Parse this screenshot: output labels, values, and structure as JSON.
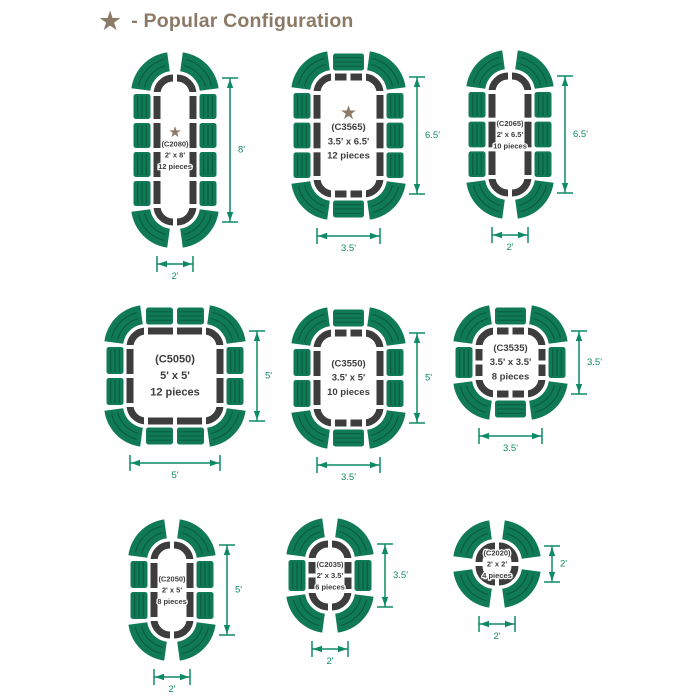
{
  "header": {
    "star_icon": "★",
    "title": "- Popular Configuration"
  },
  "colors": {
    "seat_green": "#107a57",
    "seat_stripe": "#0a5a40",
    "table_dark": "#3d3d3d",
    "dimension": "#0e8a66",
    "star": "#8c7a66",
    "background": "#ffffff"
  },
  "configurations": [
    {
      "id": "(C2080)",
      "size": "2' x 8'",
      "pieces": "12 pieces",
      "popular": true,
      "width_ft": 2,
      "height_ft": 8,
      "width_label": "2'",
      "height_label": "8'",
      "seats": {
        "left": 4,
        "right": 4,
        "top": 0,
        "bottom": 0,
        "corners": 4
      }
    },
    {
      "id": "(C3565)",
      "size": "3.5' x 6.5'",
      "pieces": "12 pieces",
      "popular": true,
      "width_ft": 3.5,
      "height_ft": 6.5,
      "width_label": "3.5'",
      "height_label": "6.5'",
      "seats": {
        "left": 3,
        "right": 3,
        "top": 1,
        "bottom": 1,
        "corners": 4
      }
    },
    {
      "id": "(C2065)",
      "size": "2' x 6.5'",
      "pieces": "10 pieces",
      "popular": false,
      "width_ft": 2,
      "height_ft": 6.5,
      "width_label": "2'",
      "height_label": "6.5'",
      "seats": {
        "left": 3,
        "right": 3,
        "top": 0,
        "bottom": 0,
        "corners": 4
      }
    },
    {
      "id": "(C5050)",
      "size": "5' x 5'",
      "pieces": "12 pieces",
      "popular": false,
      "width_ft": 5,
      "height_ft": 5,
      "width_label": "5'",
      "height_label": "5'",
      "seats": {
        "left": 2,
        "right": 2,
        "top": 2,
        "bottom": 2,
        "corners": 4
      }
    },
    {
      "id": "(C3550)",
      "size": "3.5' x 5'",
      "pieces": "10 pieces",
      "popular": false,
      "width_ft": 3.5,
      "height_ft": 5,
      "width_label": "3.5'",
      "height_label": "5'",
      "seats": {
        "left": 2,
        "right": 2,
        "top": 1,
        "bottom": 1,
        "corners": 4
      }
    },
    {
      "id": "(C3535)",
      "size": "3.5' x 3.5'",
      "pieces": "8 pieces",
      "popular": false,
      "width_ft": 3.5,
      "height_ft": 3.5,
      "width_label": "3.5'",
      "height_label": "3.5'",
      "seats": {
        "left": 1,
        "right": 1,
        "top": 1,
        "bottom": 1,
        "corners": 4
      }
    },
    {
      "id": "(C2050)",
      "size": "2' x 5'",
      "pieces": "8 pieces",
      "popular": false,
      "width_ft": 2,
      "height_ft": 5,
      "width_label": "2'",
      "height_label": "5'",
      "seats": {
        "left": 2,
        "right": 2,
        "top": 0,
        "bottom": 0,
        "corners": 4
      }
    },
    {
      "id": "(C2035)",
      "size": "2' x 3.5'",
      "pieces": "6 pieces",
      "popular": false,
      "width_ft": 2,
      "height_ft": 3.5,
      "width_label": "2'",
      "height_label": "3.5'",
      "seats": {
        "left": 1,
        "right": 1,
        "top": 0,
        "bottom": 0,
        "corners": 4
      }
    },
    {
      "id": "(C2020)",
      "size": "2' x 2'",
      "pieces": "4 pieces",
      "popular": false,
      "width_ft": 2,
      "height_ft": 2,
      "width_label": "2'",
      "height_label": "2'",
      "seats": {
        "left": 0,
        "right": 0,
        "top": 0,
        "bottom": 0,
        "corners": 4
      }
    }
  ]
}
